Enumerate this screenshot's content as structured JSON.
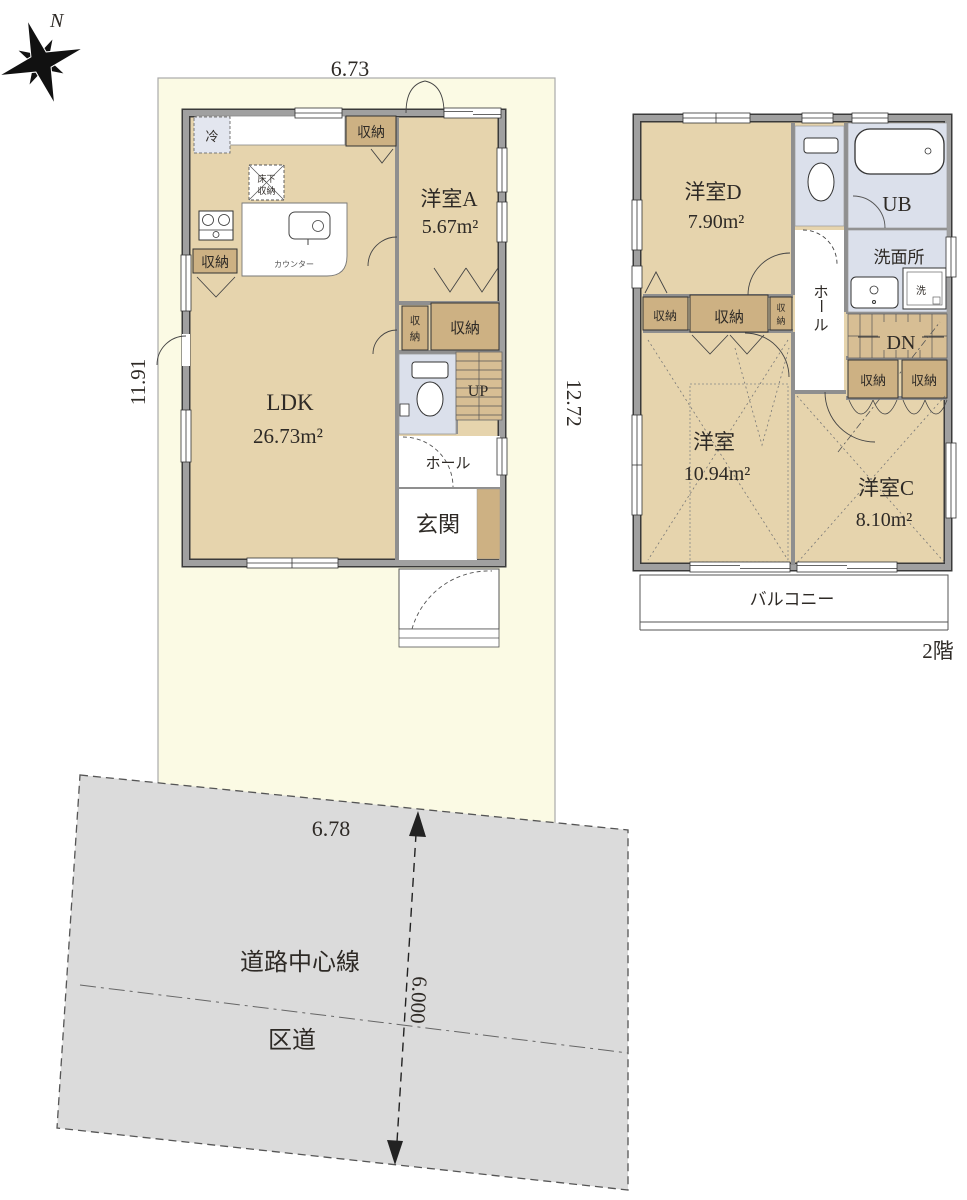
{
  "compass": {
    "north_label": "N"
  },
  "floor1": {
    "top_dimension": "6.73",
    "left_dimension": "11.91",
    "right_dimension": "12.72",
    "ldk": {
      "name": "LDK",
      "area": "26.73m²"
    },
    "room_a": {
      "name": "洋室A",
      "area": "5.67m²"
    },
    "storage_label": "収納",
    "storage_vertical": [
      "収",
      "納"
    ],
    "fridge_label": "冷",
    "underfloor_storage": [
      "床下",
      "収納"
    ],
    "counter_label": "カウンター",
    "stairs_label": "UP",
    "hall_label": "ホール",
    "entrance_label": "玄関"
  },
  "floor2": {
    "floor_label": "2階",
    "room_d": {
      "name": "洋室D",
      "area": "7.90m²"
    },
    "room_center": {
      "name": "洋室",
      "area": "10.94m²"
    },
    "room_c": {
      "name": "洋室C",
      "area": "8.10m²"
    },
    "bath_label": "UB",
    "washroom_label": "洗面所",
    "washer_label": "洗",
    "stairs_label": "DN",
    "hall_vertical": [
      "ホ",
      "ー",
      "ル"
    ],
    "storage_label": "収納",
    "storage_vertical": [
      "収",
      "納"
    ],
    "balcony_label": "バルコニー"
  },
  "road": {
    "width_top": "6.78",
    "width_vertical": "6.000",
    "centerline_label": "道路中心線",
    "type_label": "区道"
  },
  "colors": {
    "site": "#fbfae4",
    "floor": "#e6d4ad",
    "closet": "#cdb183",
    "stairs": "#d7be94",
    "water": "#dbe0eb",
    "road": "#dbdbdb",
    "wall": "#a0a0a0"
  }
}
